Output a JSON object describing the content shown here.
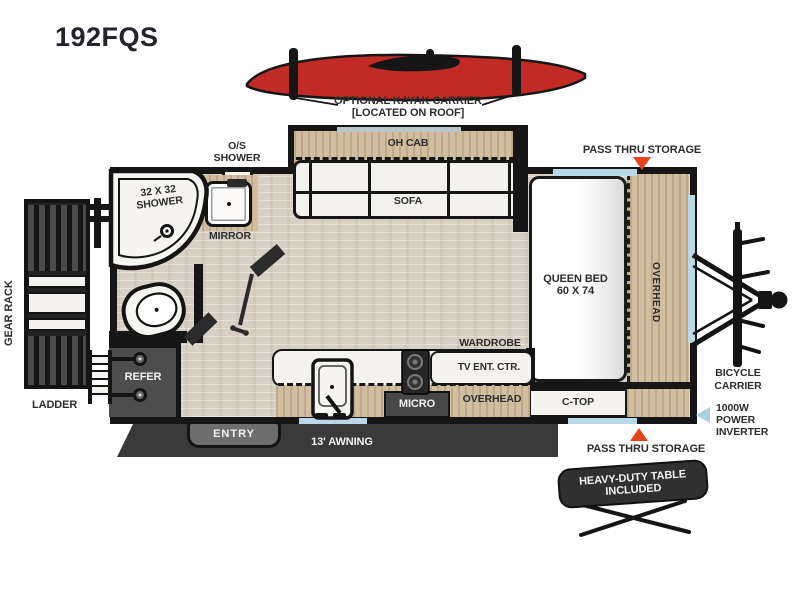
{
  "model": "192FQS",
  "roof_note": {
    "line1": "OPTIONAL KAYAK CARRIER",
    "line2": "[LOCATED ON ROOF]"
  },
  "storage": {
    "pass_thru_top": "PASS THRU STORAGE",
    "pass_thru_bottom": "PASS THRU STORAGE"
  },
  "exterior": {
    "gear_rack": "GEAR RACK",
    "ladder": "LADDER",
    "entry": "ENTRY",
    "awning": "13' AWNING",
    "bicycle": {
      "line1": "BICYCLE",
      "line2": "CARRIER"
    },
    "inverter": {
      "line1": "1000W",
      "line2": "POWER",
      "line3": "INVERTER"
    },
    "table": {
      "line1": "HEAVY-DUTY TABLE",
      "line2": "INCLUDED"
    }
  },
  "bathroom": {
    "os_shower": {
      "line1": "O/S",
      "line2": "SHOWER"
    },
    "shower": {
      "line1": "32 X 32",
      "line2": "SHOWER"
    },
    "mirror": "MIRROR"
  },
  "kitchen": {
    "refer": "REFER",
    "micro": "MICRO",
    "overhead": "OVERHEAD",
    "wardrobe": "WARDROBE",
    "tv_center": "TV ENT. CTR.",
    "c_top": "C-TOP"
  },
  "living": {
    "oh_cab": "OH CAB",
    "sofa": "SOFA"
  },
  "bedroom": {
    "bed": {
      "line1": "QUEEN BED",
      "line2": "60 X 74"
    },
    "overhead": "OVERHEAD"
  },
  "colors": {
    "kayak_red": "#c22a26",
    "arrow_red": "#e8431f",
    "window_blue": "#b9d9e8",
    "inverter_arrow_blue": "#a9cfe2",
    "wall_black": "#161616",
    "floor_wood": "#d7d0c4",
    "cabinet_wood": "#d1bd9f",
    "dark_gray": "#4d4d4d"
  }
}
